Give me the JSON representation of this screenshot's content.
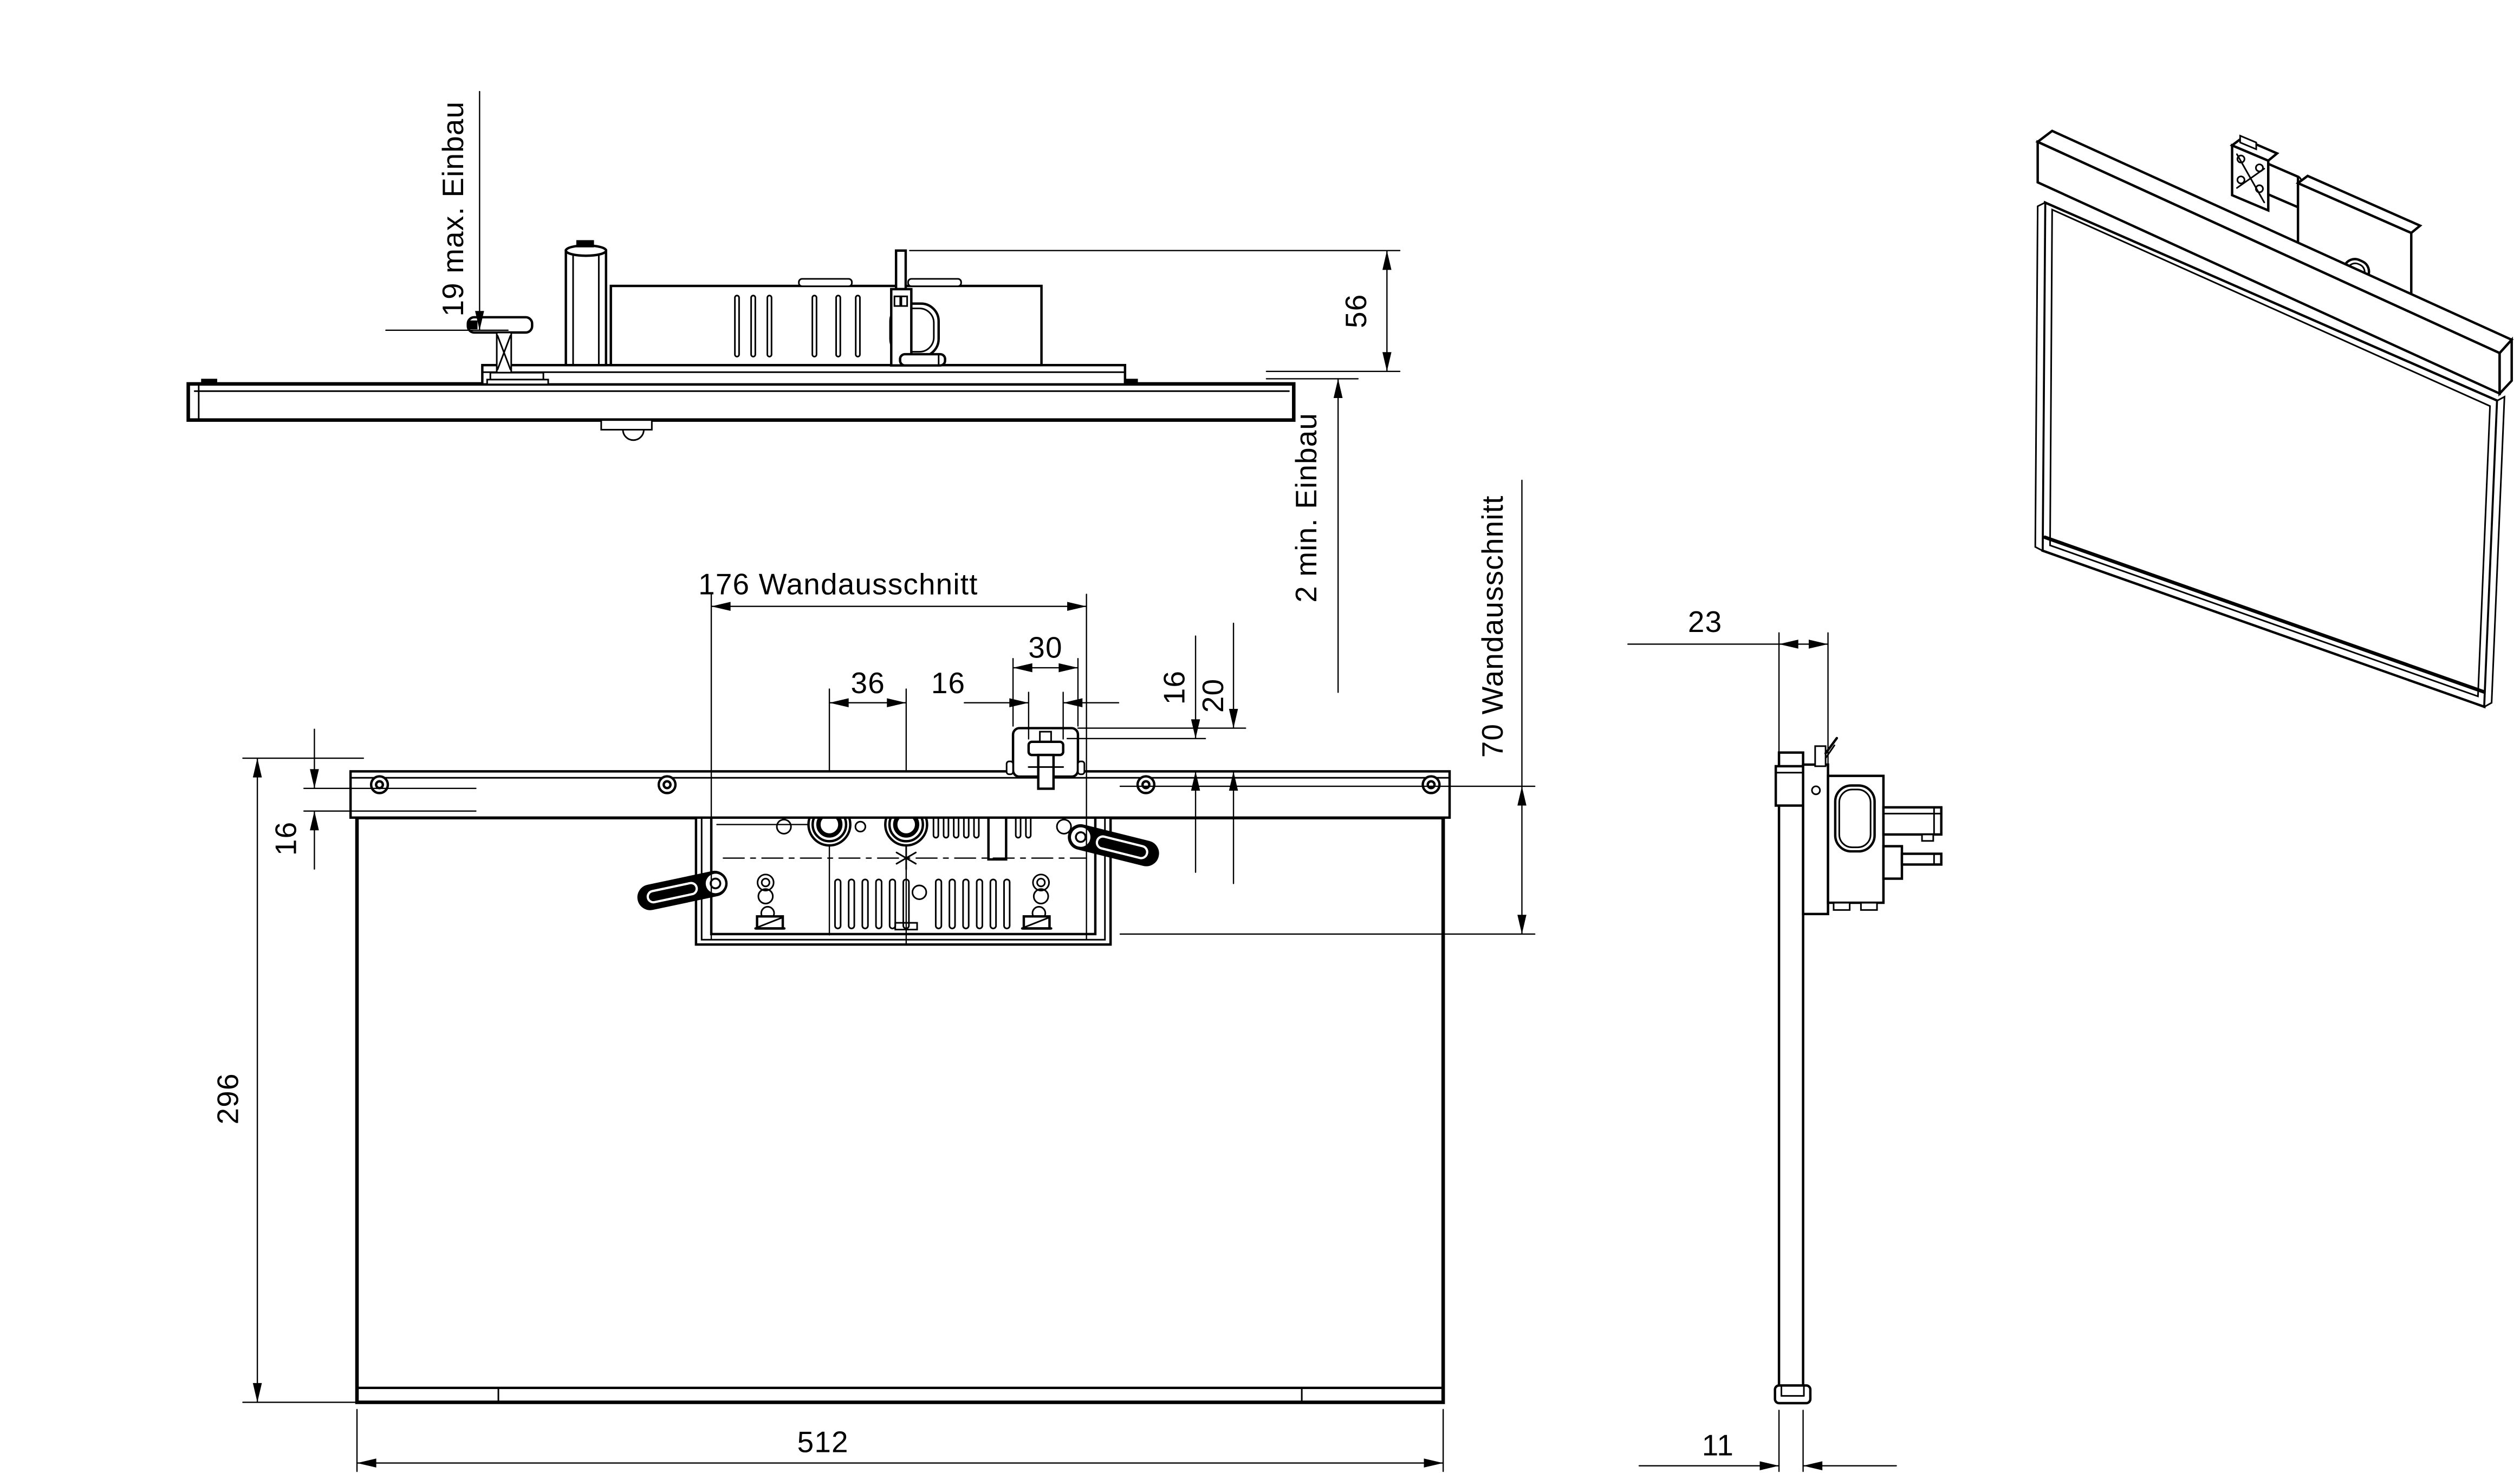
{
  "drawing": {
    "background": "#ffffff",
    "line_color": "#000000",
    "views": {
      "top": {
        "dims": {
          "max_install": "19 max. Einbau",
          "height_56": "56",
          "min_install": "2 min. Einbau"
        }
      },
      "front": {
        "dims": {
          "cutout_width": "176 Wandausschnitt",
          "hole_spacing": "36",
          "latch_inner_width": "16",
          "latch_outer_width": "30",
          "latch_height_16": "16",
          "latch_height_20": "20",
          "cutout_height": "70 Wandausschnitt",
          "edge_offset_16": "16",
          "panel_height": "296",
          "panel_width": "512"
        }
      },
      "side": {
        "dims": {
          "mount_depth": "23",
          "panel_thickness": "11"
        }
      }
    }
  }
}
